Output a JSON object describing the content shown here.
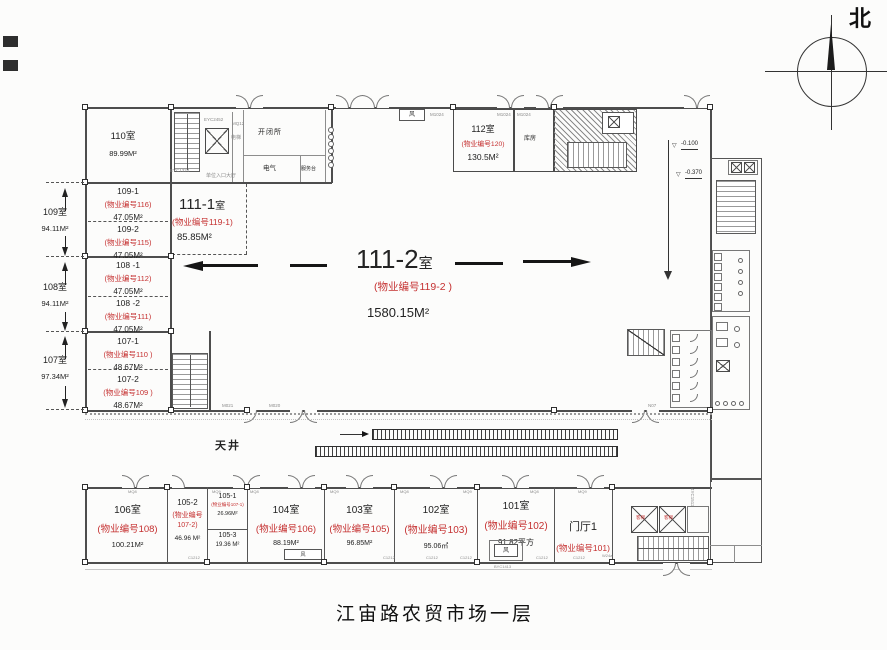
{
  "title": "江宙路农贸市场一层",
  "compass": {
    "north": "北"
  },
  "hall": {
    "num": "111-2",
    "suffix": "室",
    "prop": "(物业编号119-2 )",
    "area": "1580.15M²"
  },
  "sub111": {
    "num": "111-1",
    "suffix": "室",
    "prop": "(物业编号119-1)",
    "area": "85.85M²"
  },
  "courtyard": {
    "label": "天井"
  },
  "rooms": {
    "r110": {
      "name": "110室",
      "area": "89.99M²"
    },
    "r109_1": {
      "name": "109-1",
      "prop": "(物业编号116)",
      "area": "47.05M²"
    },
    "r109_2": {
      "name": "109-2",
      "prop": "(物业编号115)",
      "area": "47.05M²"
    },
    "r108_1": {
      "name": "108 -1",
      "prop": "(物业编号112)",
      "area": "47.05M²"
    },
    "r108_2": {
      "name": "108 -2",
      "prop": "(物业编号111)",
      "area": "47.05M²"
    },
    "r107_1": {
      "name": "107-1",
      "prop": "(物业编号110 )",
      "area": "48.67M²"
    },
    "r107_2": {
      "name": "107-2",
      "prop": "(物业编号109 )",
      "area": "48.67M²"
    },
    "r112": {
      "name": "112室",
      "prop": "(物业编号120)",
      "area": "130.5M²"
    },
    "r106": {
      "name": "106室",
      "prop": "(物业编号108)",
      "area": "100.21M²"
    },
    "r105_2": {
      "name": "105-2",
      "prop": "(物业编号107-2)",
      "area": "46.96 M²"
    },
    "r105_1": {
      "name": "105-1",
      "prop": "(物业编号107-1)",
      "area": "26.96M²"
    },
    "r105_3": {
      "name": "105-3",
      "area": "19.36 M²"
    },
    "r104": {
      "name": "104室",
      "prop": "(物业编号106)",
      "area": "88.19M²"
    },
    "r103": {
      "name": "103室",
      "prop": "(物业编号105)",
      "area": "96.85M²"
    },
    "r102": {
      "name": "102室",
      "prop": "(物业编号103)",
      "area": "95.06㎡"
    },
    "r101": {
      "name": "101室",
      "prop": "(物业编号102)",
      "area": "91.82平方"
    },
    "lobby": {
      "name": "门厅1",
      "prop": "(物业编号101)"
    }
  },
  "dims": [
    {
      "name": "109室",
      "area": "94.11M²"
    },
    {
      "name": "108室",
      "area": "94.11M²"
    },
    {
      "name": "107室",
      "area": "97.34M²"
    }
  ],
  "service": {
    "switch_station": "开闭所",
    "electrical": "电气",
    "service_desk": "服务台",
    "storage": "库房",
    "elevator": "电梯",
    "entrance_hall": "单位入口大厅",
    "vent": "风",
    "lift": "客梯"
  },
  "elevations": {
    "symbol": "▽",
    "e1": "-0.100",
    "e2": "-0.370"
  },
  "marks": {
    "m1024": "M1024",
    "mq12": "MQ12",
    "m020": "M020",
    "m021": "M021",
    "mq8": "MQ8",
    "mq9": "MQ9",
    "c1212": "C1212",
    "byc1413": "BYC1413",
    "yc1512": "4YC1512",
    "w24a": "W24a",
    "n07": "N07",
    "eyc1324": "EYC1324",
    "eyc2452": "EYC2452"
  }
}
